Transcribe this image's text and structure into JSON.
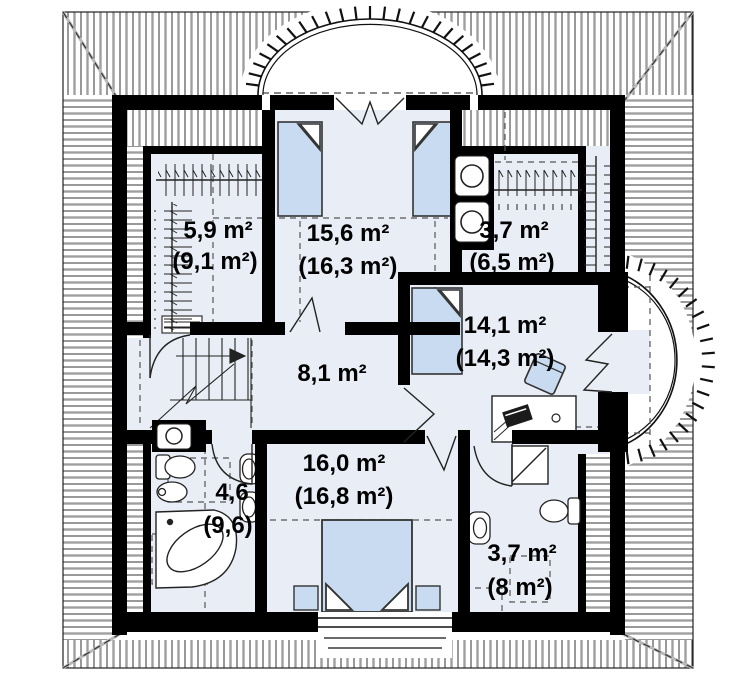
{
  "plan": {
    "type": "floor-plan",
    "floor": "attic-level",
    "colors": {
      "wall": "#000000",
      "floor": "#e9eef6",
      "furniture": "#c9dbf0",
      "hatch": "#444444",
      "dash": "#555555"
    },
    "rooms": [
      {
        "id": "wardrobe-left",
        "area": "5,9 m²",
        "area_total": "(9,1 m²)"
      },
      {
        "id": "bedroom-top",
        "area": "15,6 m²",
        "area_total": "(16,3 m²)"
      },
      {
        "id": "wardrobe-right",
        "area": "3,7 m²",
        "area_total": "(6,5 m²)"
      },
      {
        "id": "room-right",
        "area": "14,1 m²",
        "area_total": "(14,3 m²)"
      },
      {
        "id": "hall",
        "area": "8,1 m²",
        "area_total": ""
      },
      {
        "id": "bedroom-bottom",
        "area": "16,0 m²",
        "area_total": "(16,8 m²)"
      },
      {
        "id": "bathroom-left",
        "area": "4,6",
        "area_total": "(9,6)"
      },
      {
        "id": "bathroom-right",
        "area": "3,7 m²",
        "area_total": "(8 m²)"
      }
    ],
    "symbols": [
      "single-bed",
      "double-bed",
      "nightstand",
      "corner-bathtub",
      "toilet",
      "bidet",
      "sink",
      "shower",
      "washer-dryer-stack",
      "clothes-rail",
      "stairs",
      "desk",
      "chair",
      "door-swing",
      "balcony",
      "dormer-window"
    ]
  }
}
